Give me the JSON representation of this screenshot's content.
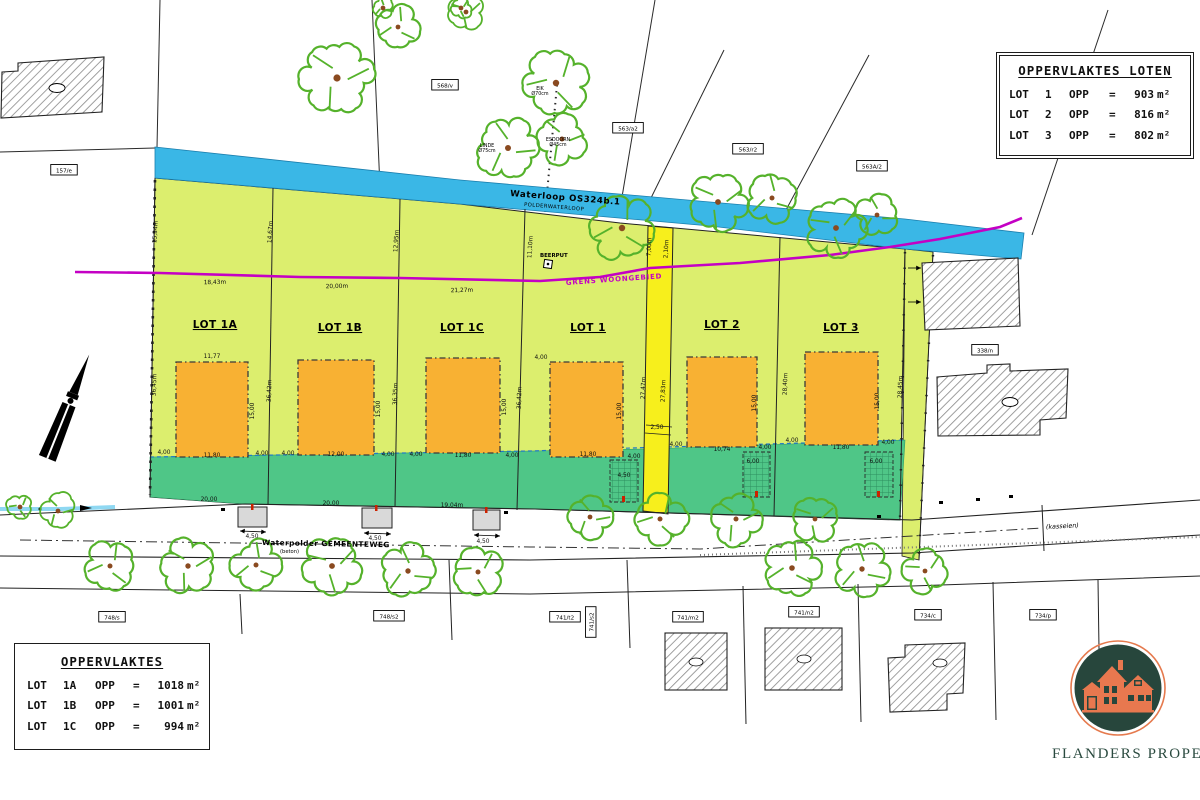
{
  "tables": {
    "loten": {
      "title": "OPPERVLAKTES LOTEN",
      "rows": [
        {
          "lot": "LOT",
          "num": "1",
          "opp": "OPP",
          "eq": "=",
          "val": "903",
          "unit": "m²"
        },
        {
          "lot": "LOT",
          "num": "2",
          "opp": "OPP",
          "eq": "=",
          "val": "816",
          "unit": "m²"
        },
        {
          "lot": "LOT",
          "num": "3",
          "opp": "OPP",
          "eq": "=",
          "val": "802",
          "unit": "m²"
        }
      ]
    },
    "opp": {
      "title": "OPPERVLAKTES",
      "rows": [
        {
          "lot": "LOT",
          "num": "1A",
          "opp": "OPP",
          "eq": "=",
          "val": "1018",
          "unit": "m²"
        },
        {
          "lot": "LOT",
          "num": "1B",
          "opp": "OPP",
          "eq": "=",
          "val": "1001",
          "unit": "m²"
        },
        {
          "lot": "LOT",
          "num": "1C",
          "opp": "OPP",
          "eq": "=",
          "val": "994",
          "unit": "m²"
        }
      ]
    }
  },
  "logo": {
    "brand": "FLANDERS PROPERTI"
  },
  "plan": {
    "waterway": {
      "name": "Waterloop OS324b.1",
      "sub": "POLDERWATERLOOP"
    },
    "grens_label": "GRENS WOONGEBIED",
    "road_label": "Waterpolder GEMEENTEWEG",
    "road_sub": "(beton)",
    "road_right": "(kasseien)",
    "beerput": "BEERPUT",
    "lots": [
      {
        "t": "LOT 1A",
        "x": 215,
        "y": 328
      },
      {
        "t": "LOT 1B",
        "x": 340,
        "y": 331
      },
      {
        "t": "LOT 1C",
        "x": 462,
        "y": 331
      },
      {
        "t": "LOT 1",
        "x": 588,
        "y": 331
      },
      {
        "t": "LOT 2",
        "x": 722,
        "y": 328
      },
      {
        "t": "LOT 3",
        "x": 841,
        "y": 331
      }
    ],
    "parcels": [
      {
        "t": "157/e",
        "x": 64,
        "y": 171
      },
      {
        "t": "568/v",
        "x": 445,
        "y": 86
      },
      {
        "t": "563/a2",
        "x": 628,
        "y": 129
      },
      {
        "t": "563/r2",
        "x": 748,
        "y": 150
      },
      {
        "t": "563A/2",
        "x": 872,
        "y": 167
      },
      {
        "t": "338/n",
        "x": 985,
        "y": 351
      },
      {
        "t": "748/s",
        "x": 112,
        "y": 618
      },
      {
        "t": "748/s2",
        "x": 389,
        "y": 617
      },
      {
        "t": "741/t2",
        "x": 565,
        "y": 618
      },
      {
        "t": "741/s2",
        "x": 592,
        "y": 622,
        "rot": -90
      },
      {
        "t": "741/m2",
        "x": 688,
        "y": 618
      },
      {
        "t": "741/n2",
        "x": 804,
        "y": 613
      },
      {
        "t": "734/c",
        "x": 928,
        "y": 616
      },
      {
        "t": "734/p",
        "x": 1043,
        "y": 616
      }
    ],
    "tree_labels": [
      {
        "t": "EIK Ø70cm",
        "x": 540,
        "y": 90
      },
      {
        "t": "LINDE Ø75cm",
        "x": 487,
        "y": 147
      },
      {
        "t": "ESDOORN Ø45cm",
        "x": 558,
        "y": 141
      }
    ],
    "dims": [
      {
        "t": "18,43m",
        "x": 215,
        "y": 284,
        "r": -1
      },
      {
        "t": "20,00m",
        "x": 337,
        "y": 288,
        "r": -1
      },
      {
        "t": "21,27m",
        "x": 462,
        "y": 292,
        "r": -1
      },
      {
        "t": "15,34m",
        "x": 157,
        "y": 232,
        "r": -86
      },
      {
        "t": "14,67m",
        "x": 272,
        "y": 232,
        "r": -86
      },
      {
        "t": "12,95m",
        "x": 398,
        "y": 241,
        "r": -86
      },
      {
        "t": "11,10m",
        "x": 532,
        "y": 247,
        "r": -86
      },
      {
        "t": "7,00m",
        "x": 651,
        "y": 247,
        "r": -87
      },
      {
        "t": "2,10m",
        "x": 668,
        "y": 249,
        "r": -87
      },
      {
        "t": "36,45m",
        "x": 156,
        "y": 385,
        "r": -88
      },
      {
        "t": "36,42m",
        "x": 271,
        "y": 391,
        "r": -88
      },
      {
        "t": "36,35m",
        "x": 397,
        "y": 394,
        "r": -88
      },
      {
        "t": "36,42m",
        "x": 521,
        "y": 398,
        "r": -88
      },
      {
        "t": "27,47m",
        "x": 645,
        "y": 388,
        "r": -88
      },
      {
        "t": "27,83m",
        "x": 665,
        "y": 391,
        "r": -88
      },
      {
        "t": "28,40m",
        "x": 787,
        "y": 384,
        "r": -88
      },
      {
        "t": "28,45m",
        "x": 902,
        "y": 387,
        "r": -88
      },
      {
        "t": "11,77",
        "x": 212,
        "y": 358
      },
      {
        "t": "15,00",
        "x": 254,
        "y": 411,
        "r": -90
      },
      {
        "t": "11,80",
        "x": 212,
        "y": 457
      },
      {
        "t": "4,00",
        "x": 164,
        "y": 454
      },
      {
        "t": "4,00",
        "x": 262,
        "y": 455
      },
      {
        "t": "12,00",
        "x": 336,
        "y": 456
      },
      {
        "t": "15,00",
        "x": 380,
        "y": 409,
        "r": -90
      },
      {
        "t": "4,00",
        "x": 288,
        "y": 455
      },
      {
        "t": "4,00",
        "x": 388,
        "y": 456
      },
      {
        "t": "11,80",
        "x": 463,
        "y": 457
      },
      {
        "t": "15,00",
        "x": 506,
        "y": 407,
        "r": -90
      },
      {
        "t": "4,00",
        "x": 416,
        "y": 456
      },
      {
        "t": "4,00",
        "x": 512,
        "y": 457
      },
      {
        "t": "4,00",
        "x": 541,
        "y": 359
      },
      {
        "t": "11,80",
        "x": 588,
        "y": 456
      },
      {
        "t": "15,00",
        "x": 621,
        "y": 411,
        "r": -90
      },
      {
        "t": "4,00",
        "x": 634,
        "y": 458
      },
      {
        "t": "10,74",
        "x": 722,
        "y": 451
      },
      {
        "t": "15,00",
        "x": 756,
        "y": 403,
        "r": -90
      },
      {
        "t": "4,00",
        "x": 676,
        "y": 446
      },
      {
        "t": "4,00",
        "x": 765,
        "y": 449
      },
      {
        "t": "11,80",
        "x": 841,
        "y": 449
      },
      {
        "t": "15,00",
        "x": 879,
        "y": 401,
        "r": -90
      },
      {
        "t": "4,00",
        "x": 792,
        "y": 442
      },
      {
        "t": "4,00",
        "x": 888,
        "y": 444
      },
      {
        "t": "2,50",
        "x": 657,
        "y": 429
      },
      {
        "t": "20,00",
        "x": 209,
        "y": 501
      },
      {
        "t": "20,00",
        "x": 331,
        "y": 505
      },
      {
        "t": "19,04m",
        "x": 452,
        "y": 507
      },
      {
        "t": "4,50",
        "x": 252,
        "y": 538
      },
      {
        "t": "4,50",
        "x": 375,
        "y": 540
      },
      {
        "t": "4,50",
        "x": 483,
        "y": 543
      },
      {
        "t": "4,50",
        "x": 624,
        "y": 477
      },
      {
        "t": "6,00",
        "x": 753,
        "y": 463
      },
      {
        "t": "6,00",
        "x": 876,
        "y": 463
      }
    ]
  }
}
